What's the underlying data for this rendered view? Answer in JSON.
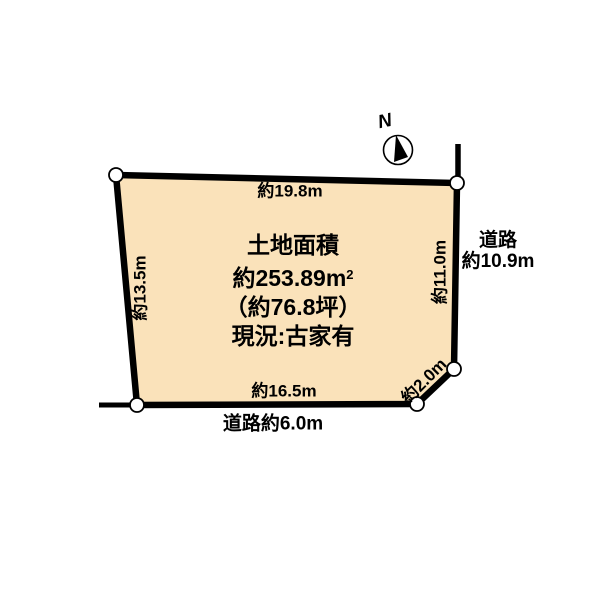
{
  "compass": {
    "north_label": "N"
  },
  "parcel": {
    "area_title": "土地面積",
    "area_value": "約253.89m",
    "area_value_sup": "2",
    "area_tsubo": "（約76.8坪）",
    "status": "現況:古家有"
  },
  "dimensions": {
    "top": "約19.8m",
    "left": "約13.5m",
    "right": "約11.0m",
    "bottom": "約16.5m",
    "chamfer": "約2.0m"
  },
  "roads": {
    "bottom_label": "道路約6.0m",
    "right_label_line1": "道路",
    "right_label_line2": "約10.9m"
  },
  "colors": {
    "parcel_fill": "#FAE2BA",
    "line": "#000000",
    "marker_fill": "#FFFFFF",
    "background": "#FFFFFF"
  }
}
